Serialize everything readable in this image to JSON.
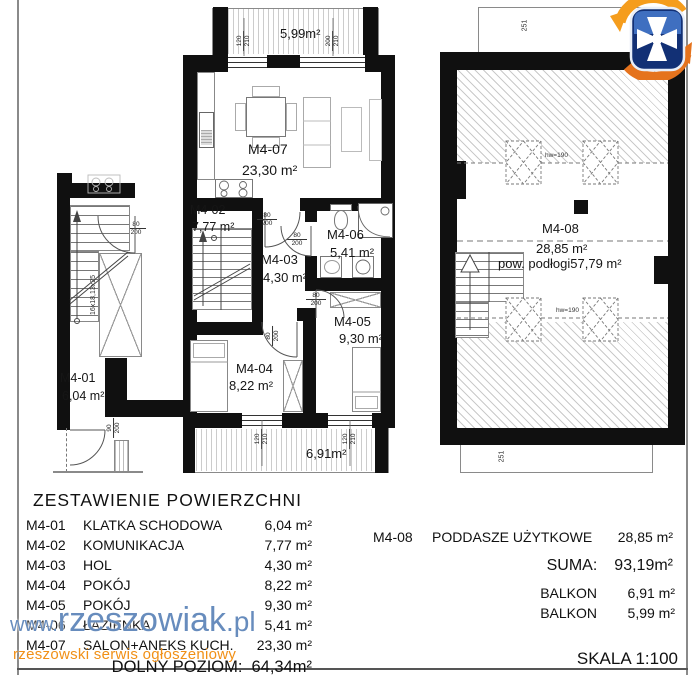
{
  "watermark": {
    "www": "www.",
    "brand": "rzeszowiak",
    "tld": ".pl",
    "tagline": "rzeszowski serwis ogłoszeniowy"
  },
  "scale_label": "SKALA 1:100",
  "lower_table": {
    "title": "ZESTAWIENIE POWIERZCHNI",
    "rows": [
      {
        "code": "M4-01",
        "name": "KLATKA SCHODOWA",
        "area": "6,04 m²"
      },
      {
        "code": "M4-02",
        "name": "KOMUNIKACJA",
        "area": "7,77 m²"
      },
      {
        "code": "M4-03",
        "name": "HOL",
        "area": "4,30 m²"
      },
      {
        "code": "M4-04",
        "name": "POKÓJ",
        "area": "8,22 m²"
      },
      {
        "code": "M4-05",
        "name": "POKÓJ",
        "area": "9,30 m²"
      },
      {
        "code": "M4-06",
        "name": "ŁAZIENKA",
        "area": "5,41 m²"
      },
      {
        "code": "M4-07",
        "name": "SALON+ANEKS KUCH.",
        "area": "23,30 m²"
      }
    ],
    "total_label": "DOLNY POZIOM:",
    "total_value": "64,34m²"
  },
  "upper_table": {
    "code": "M4-08",
    "name": "PODDASZE UŻYTKOWE",
    "area": "28,85 m²",
    "suma_label": "SUMA:",
    "suma_value": "93,19m²",
    "balkon1_label": "BALKON",
    "balkon1_value": "6,91 m²",
    "balkon2_label": "BALKON",
    "balkon2_value": "5,99 m²"
  },
  "plan": {
    "m401": {
      "code": "M4-01",
      "area": "6,04 m²"
    },
    "m402": {
      "code": "M4-02",
      "area": "7,77 m²"
    },
    "m403": {
      "code": "M4-03",
      "area": "4,30 m²"
    },
    "m404": {
      "code": "M4-04",
      "area": "8,22 m²"
    },
    "m405": {
      "code": "M4-05",
      "area": "9,30 m²"
    },
    "m406": {
      "code": "M4-06",
      "area": "5,41 m²"
    },
    "m407": {
      "code": "M4-07",
      "area": "23,30 m²"
    },
    "m408": {
      "code": "M4-08",
      "area": "28,85 m²",
      "floor_note": "pow. podłogi57,79 m²"
    },
    "balcony_top": "5,99m²",
    "balcony_bottom": "6,91m²",
    "stair_note": "16x18,13x25",
    "hw1": "hw=190",
    "hw2": "hw=190",
    "roof_dim_top": "251",
    "roof_dim_bottom": "251",
    "dims": {
      "d1": {
        "a": "80",
        "b": "200"
      },
      "d2": {
        "a": "80",
        "b": "200"
      },
      "d3": {
        "a": "80",
        "b": "200"
      },
      "d4": {
        "a": "80",
        "b": "200"
      },
      "d5": {
        "a": "80",
        "b": "200"
      },
      "d6": {
        "a": "90",
        "b": "200"
      },
      "w1": {
        "a": "120",
        "b": "210"
      },
      "w2": {
        "a": "200",
        "b": "210"
      },
      "w3": {
        "a": "120",
        "b": "210"
      },
      "w4": {
        "a": "120",
        "b": "210"
      }
    }
  }
}
